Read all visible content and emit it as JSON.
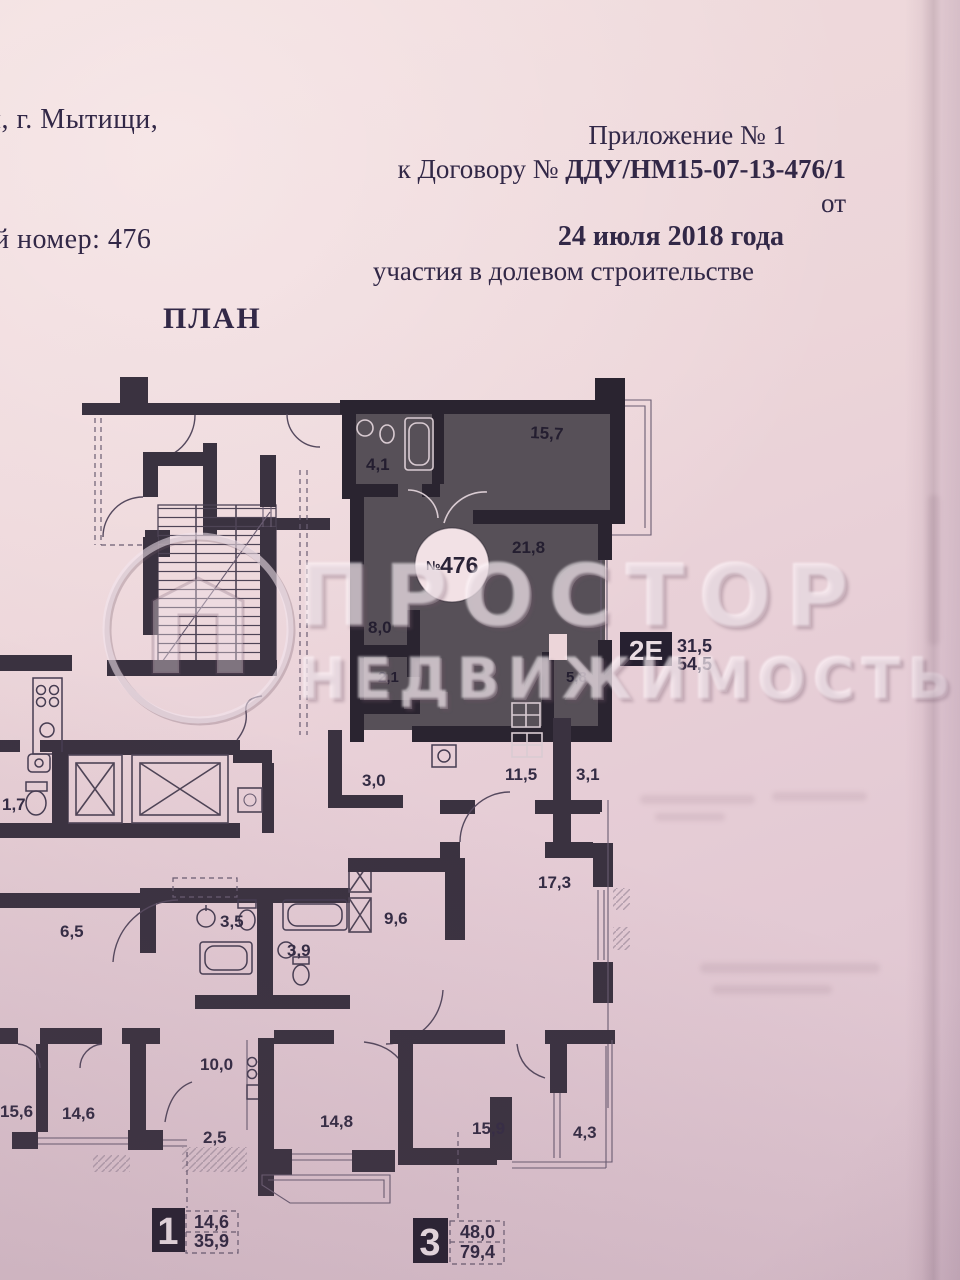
{
  "page": {
    "header_left": {
      "line1": "и, г. Мытищи,",
      "line2": "й номер: 476"
    },
    "appendix": {
      "line1": "Приложение № 1",
      "line2_prefix": "к Договору № ",
      "line2_bold": "ДДУ/НМ15-07-13-476/1",
      "line2_suffix": " от",
      "line3": "24 июля 2018 года",
      "line4": "участия в долевом строительстве"
    },
    "plan_title": "ПЛАН"
  },
  "watermark": {
    "line1": "ПРОСТОР",
    "line2": "НЕДВИЖИМОСТЬ"
  },
  "plan": {
    "unit_circle": {
      "prefix": "№",
      "number": "476"
    },
    "unit_type": {
      "code": "2Е",
      "living_area": "31,5",
      "total_area": "54,5"
    },
    "areas": {
      "a15_7": "15,7",
      "a4_1": "4,1",
      "a21_8": "21,8",
      "a8_0": "8,0",
      "a2_1": "2,1",
      "a5_8": "5,8",
      "a3_0": "3,0",
      "a11_5": "11,5",
      "a3_1": "3,1",
      "a1_7": "1,7",
      "a17_3": "17,3",
      "a9_6": "9,6",
      "a3_5": "3,5",
      "a3_9": "3,9",
      "a6_5": "6,5",
      "a10_0": "10,0",
      "a2_5": "2,5",
      "a15_6": "15,6",
      "a14_6": "14,6",
      "a14_8": "14,8",
      "a15_9": "15,9",
      "a4_3": "4,3"
    },
    "legend": [
      {
        "number": "1",
        "living_area": "14,6",
        "total_area": "35,9"
      },
      {
        "number": "3",
        "living_area": "48,0",
        "total_area": "79,4"
      }
    ]
  }
}
